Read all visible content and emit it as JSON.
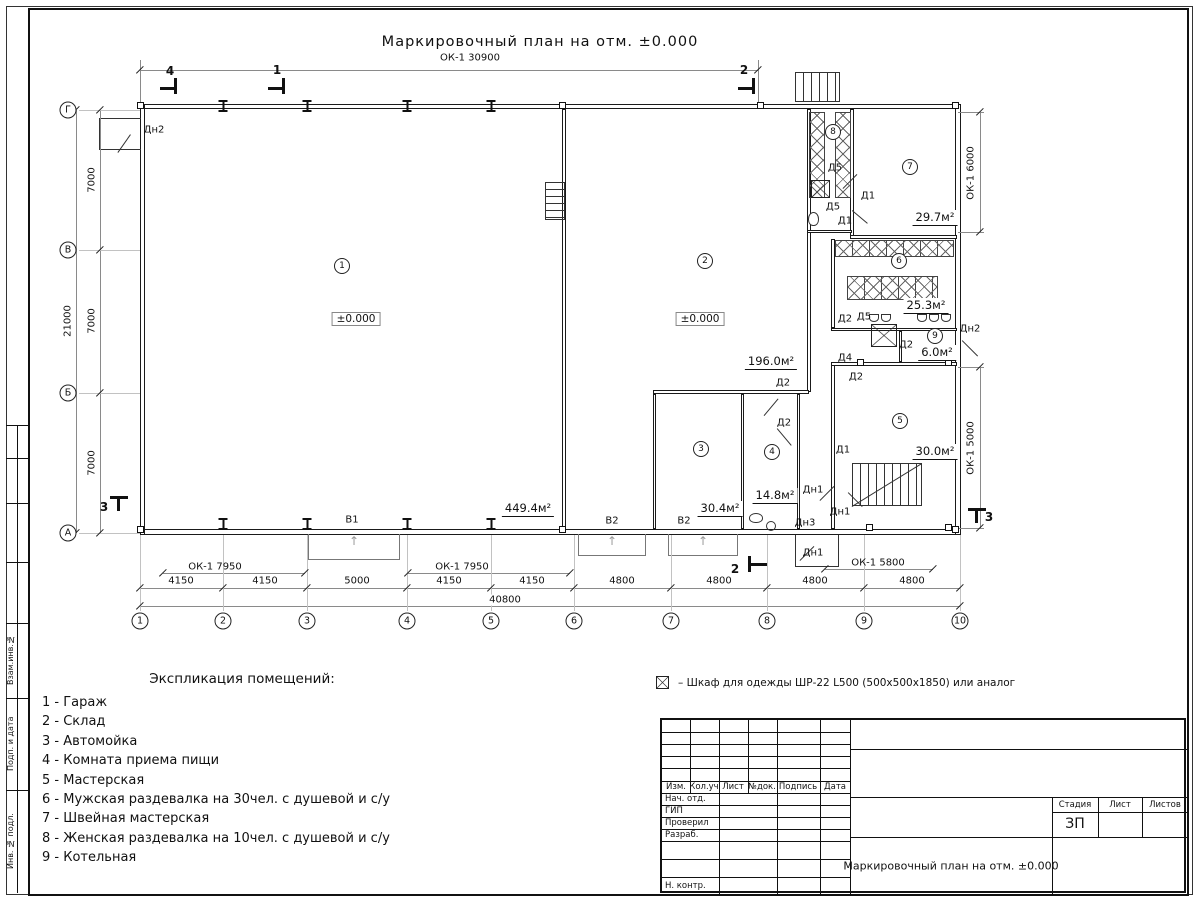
{
  "sheet": {
    "title": "Маркировочный план на отм. ±0.000"
  },
  "plan": {
    "dim_top": "ОК-1 30900",
    "dims_bottom": [
      "4150",
      "4150",
      "5000",
      "4150",
      "4150",
      "4800",
      "4800",
      "4800",
      "4800"
    ],
    "dim_total": "40800",
    "dims_left": [
      "7000",
      "7000",
      "7000"
    ],
    "dim_left_total": "21000",
    "dims_right": [
      "ОК-1 6000",
      "ОК-1 5000"
    ],
    "window_dims": [
      "ОК-1 7950",
      "ОК-1 7950",
      "ОК-1 5800"
    ],
    "grid_cols": [
      "1",
      "2",
      "3",
      "4",
      "5",
      "6",
      "7",
      "8",
      "9",
      "10"
    ],
    "grid_rows": [
      "Г",
      "В",
      "Б",
      "А"
    ],
    "room_nums": [
      "1",
      "2",
      "3",
      "4",
      "5",
      "6",
      "7",
      "8",
      "9"
    ],
    "areas": [
      "449.4м²",
      "196.0м²",
      "30.4м²",
      "14.8м²",
      "30.0м²",
      "25.3м²",
      "29.7м²",
      "6.0м²"
    ],
    "levels": [
      "±0.000",
      "±0.000"
    ],
    "door_tags": [
      "Дн2",
      "Д5",
      "Д1",
      "Д5",
      "Д1",
      "Д2",
      "Д2",
      "Д2",
      "Д5",
      "Д2",
      "Д4",
      "Д2",
      "Д1",
      "Дн1",
      "Дн1",
      "Дн3",
      "Дн1",
      "Дн2"
    ],
    "gate_labels": [
      "В1",
      "В2",
      "В2"
    ],
    "sections": [
      "4",
      "1",
      "2",
      "2",
      "3",
      "3"
    ]
  },
  "legend": {
    "heading": "Экспликация помещений:",
    "items": [
      "1 - Гараж",
      "2 - Склад",
      "3 - Автомойка",
      "4 - Комната приема пищи",
      "5 - Мастерская",
      "6 - Мужская раздевалка на 30чел. с душевой и с/у",
      "7 - Швейная мастерская",
      "8 - Женская раздевалка на 10чел. с душевой и с/у",
      "9 - Котельная"
    ]
  },
  "note": {
    "symbol": "crossed-square-wardrobe",
    "text": "– Шкаф для одежды ШР-22 L500 (500x500x1850) или аналог"
  },
  "titleblock": {
    "cols": [
      "Изм.",
      "Кол.уч",
      "Лист",
      "№док.",
      "Подпись",
      "Дата"
    ],
    "rows": [
      "Нач. отд.",
      "ГИП",
      "Проверил",
      "Разраб.",
      "Н. контр."
    ],
    "stage_cols": [
      "Стадия",
      "Лист",
      "Листов"
    ],
    "stage": "ЗП",
    "doc_title": "Маркировочный план на отм. ±0.000"
  },
  "frame": {
    "labels": [
      "Взам.инв.№",
      "Подп. и дата",
      "Инв. № подл."
    ]
  }
}
